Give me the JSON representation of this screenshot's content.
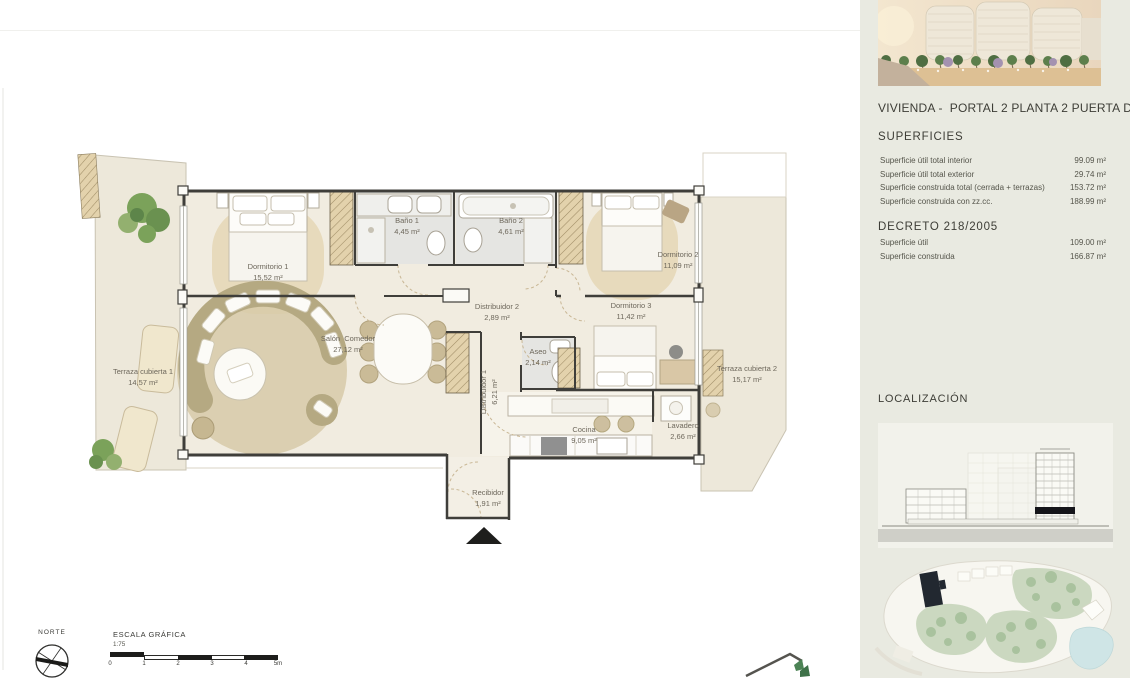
{
  "colors": {
    "sidebar_bg": "#e9eae1",
    "wall": "#3f3e3a",
    "interior_floor": "#f1ece0",
    "terrace_floor": "#ede8da",
    "bath_floor": "#e5e5e2",
    "rug_wood": "#e7dabc",
    "plant_green": "#7ba25a",
    "pool_blue": "#cfe5e6",
    "site_marker": "#222830"
  },
  "sidebar": {
    "title": "VIVIENDA -  PORTAL 2 PLANTA 2 PUERTA D",
    "superficies_heading": "SUPERFICIES",
    "superficies_rows": [
      {
        "label": "Superficie útil total interior",
        "value": "99.09 m²"
      },
      {
        "label": "Superficie útil total exterior",
        "value": "29.74 m²"
      },
      {
        "label": "Superficie construida total (cerrada + terrazas)",
        "value": "153.72 m²"
      },
      {
        "label": "Superficie construida con zz.cc.",
        "value": "188.99 m²"
      }
    ],
    "decreto_heading": "DECRETO 218/2005",
    "decreto_rows": [
      {
        "label": "Superficie útil",
        "value": "109.00 m²"
      },
      {
        "label": "Superficie construida",
        "value": "166.87 m²"
      }
    ],
    "localizacion_heading": "LOCALIZACIÓN"
  },
  "plan": {
    "rooms": [
      {
        "name": "Dormitorio 1",
        "area": "15,52 m²"
      },
      {
        "name": "Baño 1",
        "area": "4,45 m²"
      },
      {
        "name": "Baño 2",
        "area": "4,61 m²"
      },
      {
        "name": "Dormitorio 2",
        "area": "11,09 m²"
      },
      {
        "name": "Dormitorio 3",
        "area": "11,42 m²"
      },
      {
        "name": "Distribuidor 2",
        "area": "2,89 m²"
      },
      {
        "name": "Aseo",
        "area": "2,14 m²"
      },
      {
        "name": "Distribuidor 1",
        "area": "6,21 m²"
      },
      {
        "name": "Salón  Comedor",
        "area": "27,12 m²"
      },
      {
        "name": "Cocina",
        "area": "9,05 m²"
      },
      {
        "name": "Lavadero",
        "area": "2,66 m²"
      },
      {
        "name": "Recibidor",
        "area": "1,91 m²"
      },
      {
        "name": "Terraza cubierta 1",
        "area": "14,57 m²"
      },
      {
        "name": "Terraza cubierta 2",
        "area": "15,17 m²"
      }
    ],
    "north_label": "NORTE",
    "scale_heading": "ESCALA GRÁFICA",
    "scale_ratio": "1:75",
    "scale_ticks": [
      "0",
      "1",
      "2",
      "3",
      "4",
      "5m"
    ]
  },
  "icons": {
    "north_compass": "compass-rose",
    "entrance_arrow": "triangle-up",
    "developer_logo": "house-roof-with-tree"
  }
}
